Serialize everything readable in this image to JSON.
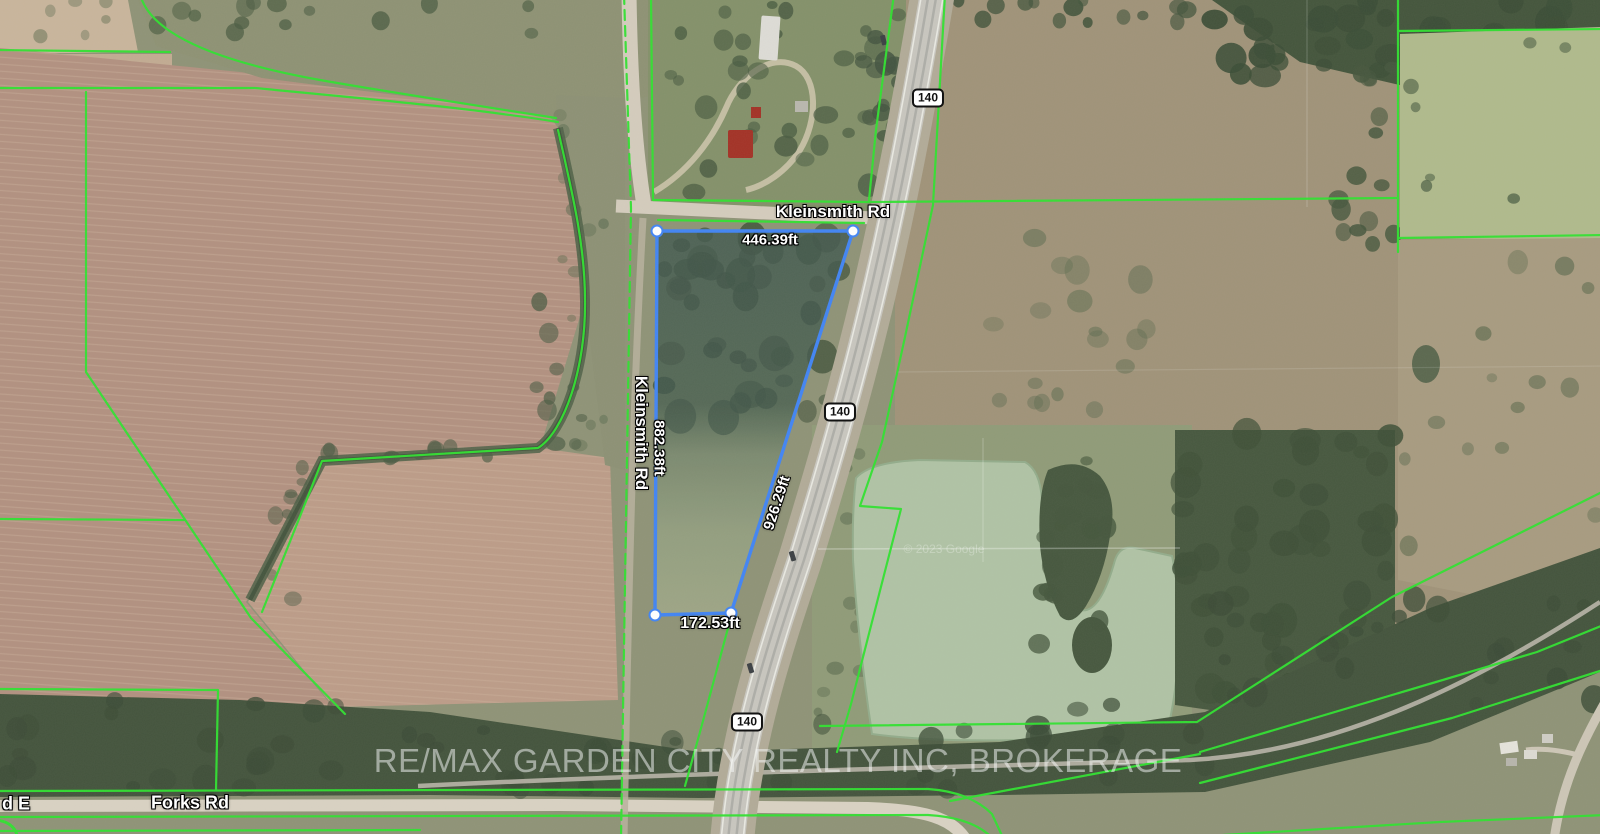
{
  "map": {
    "labels": {
      "kleinsmith_rd": "Kleinsmith Rd",
      "forks_rd": "Forks Rd",
      "road_partial_left": "d E",
      "highway_shield": "140"
    },
    "measurements": {
      "top": "446.39ft",
      "left": "882.38ft",
      "diagonal": "926.29ft",
      "bottom": "172.53ft"
    },
    "watermark": "RE/MAX GARDEN CITY REALTY INC, BROKERAGE",
    "imagery_credit": "© 2023 Google",
    "colors": {
      "parcel_stroke": "#4285f4",
      "boundary_green": "#31e231",
      "label_text": "#ffffff"
    }
  }
}
